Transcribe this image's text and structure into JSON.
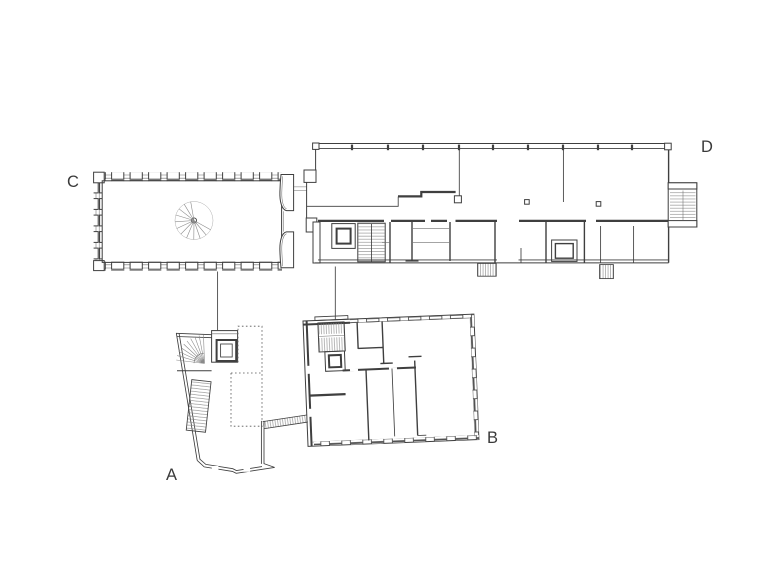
{
  "drawing": {
    "labels": {
      "a": "A",
      "b": "B",
      "c": "C",
      "d": "D"
    },
    "colors": {
      "line": "#3f3f3f",
      "hatch": "#8a8a8a",
      "background": "#ffffff"
    }
  }
}
